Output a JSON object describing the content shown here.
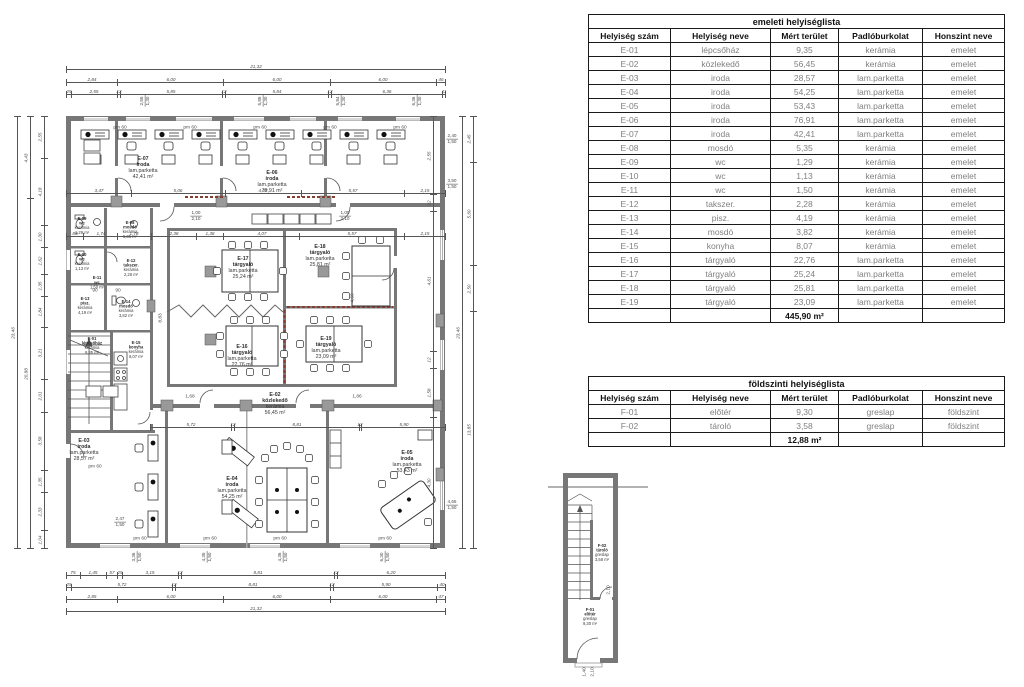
{
  "tables": {
    "emeleti": {
      "title": "emeleti helyiséglista",
      "headers": [
        "Helyiség szám",
        "Helyiség neve",
        "Mért terület",
        "Padlóburkolat",
        "Honszint neve"
      ],
      "col_widths": [
        82,
        100,
        68,
        84,
        82
      ],
      "rows": [
        [
          "E-01",
          "lépcsőház",
          "9,35",
          "kerámia",
          "emelet"
        ],
        [
          "E-02",
          "közlekedő",
          "56,45",
          "kerámia",
          "emelet"
        ],
        [
          "E-03",
          "iroda",
          "28,57",
          "lam.parketta",
          "emelet"
        ],
        [
          "E-04",
          "iroda",
          "54,25",
          "lam.parketta",
          "emelet"
        ],
        [
          "E-05",
          "iroda",
          "53,43",
          "lam.parketta",
          "emelet"
        ],
        [
          "E-06",
          "iroda",
          "76,91",
          "lam.parketta",
          "emelet"
        ],
        [
          "E-07",
          "iroda",
          "42,41",
          "lam.parketta",
          "emelet"
        ],
        [
          "E-08",
          "mosdó",
          "5,35",
          "kerámia",
          "emelet"
        ],
        [
          "E-09",
          "wc",
          "1,29",
          "kerámia",
          "emelet"
        ],
        [
          "E-10",
          "wc",
          "1,13",
          "kerámia",
          "emelet"
        ],
        [
          "E-11",
          "wc",
          "1,50",
          "kerámia",
          "emelet"
        ],
        [
          "E-12",
          "takszer.",
          "2,28",
          "kerámia",
          "emelet"
        ],
        [
          "E-13",
          "pisz.",
          "4,19",
          "kerámia",
          "emelet"
        ],
        [
          "E-14",
          "mosdó",
          "3,82",
          "kerámia",
          "emelet"
        ],
        [
          "E-15",
          "konyha",
          "8,07",
          "kerámia",
          "emelet"
        ],
        [
          "E-16",
          "tárgyaló",
          "22,76",
          "lam.parketta",
          "emelet"
        ],
        [
          "E-17",
          "tárgyaló",
          "25,24",
          "lam.parketta",
          "emelet"
        ],
        [
          "E-18",
          "tárgyaló",
          "25,81",
          "lam.parketta",
          "emelet"
        ],
        [
          "E-19",
          "tárgyaló",
          "23,09",
          "lam.parketta",
          "emelet"
        ]
      ],
      "total": "445,90 m²"
    },
    "foldszinti": {
      "title": "földszinti helyiséglista",
      "headers": [
        "Helyiség szám",
        "Helyiség neve",
        "Mért terület",
        "Padlóburkolat",
        "Honszint neve"
      ],
      "col_widths": [
        82,
        100,
        68,
        84,
        82
      ],
      "rows": [
        [
          "F-01",
          "előtér",
          "9,30",
          "greslap",
          "földszint"
        ],
        [
          "F-02",
          "tároló",
          "3,58",
          "greslap",
          "földszint"
        ]
      ],
      "total": "12,88 m²"
    }
  },
  "floor_plan": {
    "room_labels": [
      {
        "x": 143,
        "y": 168,
        "small": false,
        "lines": [
          "E-07",
          "iroda",
          "lam.parketta",
          "42,41 m²"
        ]
      },
      {
        "x": 272,
        "y": 182,
        "small": false,
        "lines": [
          "E-06",
          "iroda",
          "lam.parketta",
          "76,91 m²"
        ]
      },
      {
        "x": 82,
        "y": 226,
        "small": true,
        "lines": [
          "E-09",
          "wc",
          "kerámia",
          "1,29 m²"
        ]
      },
      {
        "x": 130,
        "y": 230,
        "small": true,
        "lines": [
          "E-08",
          "mosdó",
          "kerámia",
          "5,35 m²"
        ]
      },
      {
        "x": 82,
        "y": 262,
        "small": true,
        "lines": [
          "E-10",
          "wc",
          "kerámia",
          "1,13 m²"
        ]
      },
      {
        "x": 131,
        "y": 268,
        "small": true,
        "lines": [
          "E-12",
          "takszer.",
          "kerámia",
          "2,28 m²"
        ]
      },
      {
        "x": 97,
        "y": 283,
        "small": true,
        "lines": [
          "E-11",
          "wc",
          "1,50 m²"
        ]
      },
      {
        "x": 85,
        "y": 306,
        "small": true,
        "lines": [
          "E-13",
          "pisz.",
          "kerámia",
          "4,19 m²"
        ]
      },
      {
        "x": 126,
        "y": 309,
        "small": true,
        "lines": [
          "E-14",
          "mosdó",
          "kerámia",
          "3,82 m²"
        ]
      },
      {
        "x": 92,
        "y": 346,
        "small": true,
        "lines": [
          "E-01",
          "lépcsőház",
          "kerámia",
          "9,35 m²"
        ]
      },
      {
        "x": 136,
        "y": 350,
        "small": true,
        "lines": [
          "E-15",
          "konyha",
          "kerámia",
          "8,07 m²"
        ]
      },
      {
        "x": 243,
        "y": 268,
        "small": false,
        "lines": [
          "E-17",
          "tárgyaló",
          "lam.parketta",
          "25,24 m²"
        ]
      },
      {
        "x": 320,
        "y": 256,
        "small": false,
        "lines": [
          "E-18",
          "tárgyaló",
          "lam.parketta",
          "25,81 m²"
        ]
      },
      {
        "x": 242,
        "y": 356,
        "small": false,
        "lines": [
          "E-16",
          "tárgyaló",
          "lam.parketta",
          "22,76 m²"
        ]
      },
      {
        "x": 326,
        "y": 348,
        "small": false,
        "lines": [
          "E-19",
          "tárgyaló",
          "lam.parketta",
          "23,09 m²"
        ]
      },
      {
        "x": 275,
        "y": 404,
        "small": false,
        "lines": [
          "E-02",
          "közlekedő",
          "kerámia",
          "56,45 m²"
        ]
      },
      {
        "x": 84,
        "y": 450,
        "small": false,
        "lines": [
          "E-03",
          "iroda",
          "lam.parketta",
          "28,57 m²"
        ]
      },
      {
        "x": 232,
        "y": 488,
        "small": false,
        "lines": [
          "E-04",
          "iroda",
          "lam.parketta",
          "54,25 m²"
        ]
      },
      {
        "x": 407,
        "y": 462,
        "small": false,
        "lines": [
          "E-05",
          "iroda",
          "lam.parketta",
          "53,43 m²"
        ]
      }
    ],
    "annotations": [
      {
        "x": 120,
        "y": 127,
        "t": "pm 60"
      },
      {
        "x": 190,
        "y": 127,
        "t": "pm 60"
      },
      {
        "x": 260,
        "y": 127,
        "t": "pm 60"
      },
      {
        "x": 330,
        "y": 127,
        "t": "pm 60"
      },
      {
        "x": 400,
        "y": 127,
        "t": "pm 60"
      },
      {
        "x": 140,
        "y": 538,
        "t": "pm 60"
      },
      {
        "x": 210,
        "y": 538,
        "t": "pm 60"
      },
      {
        "x": 280,
        "y": 538,
        "t": "pm 60"
      },
      {
        "x": 385,
        "y": 538,
        "t": "pm 60"
      },
      {
        "x": 95,
        "y": 466,
        "t": "pm 60"
      },
      {
        "x": 95,
        "y": 290,
        "t": "90"
      },
      {
        "x": 118,
        "y": 290,
        "t": "90"
      },
      {
        "x": 160,
        "y": 318,
        "t": "8,83",
        "rot": true
      },
      {
        "x": 352,
        "y": 298,
        "t": "4,60",
        "rot": true
      },
      {
        "x": 190,
        "y": 396,
        "t": "1,68"
      },
      {
        "x": 357,
        "y": 396,
        "t": "1,86"
      }
    ],
    "fractions": [
      {
        "x": 452,
        "y": 139,
        "top": "2,40",
        "bottom": "1,50"
      },
      {
        "x": 452,
        "y": 184,
        "top": "3,50",
        "bottom": "1,50"
      },
      {
        "x": 452,
        "y": 505,
        "top": "4,65",
        "bottom": "1,50"
      },
      {
        "x": 120,
        "y": 522,
        "top": "2,47",
        "bottom": "1,50"
      },
      {
        "x": 196,
        "y": 216,
        "top": "1,00",
        "bottom": "2,10"
      },
      {
        "x": 345,
        "y": 216,
        "top": "1,00",
        "bottom": "2,10"
      },
      {
        "x": 145,
        "y": 101,
        "top": "2,55",
        "bottom": "1,30",
        "rot": true
      },
      {
        "x": 263,
        "y": 101,
        "top": "5,85",
        "bottom": "1,30",
        "rot": true
      },
      {
        "x": 341,
        "y": 101,
        "top": "5,84",
        "bottom": "1,30",
        "rot": true
      },
      {
        "x": 417,
        "y": 101,
        "top": "6,36",
        "bottom": "1,30",
        "rot": true
      },
      {
        "x": 137,
        "y": 557,
        "top": "3,36",
        "bottom": "1,50",
        "rot": true
      },
      {
        "x": 207,
        "y": 557,
        "top": "4,35",
        "bottom": "1,50",
        "rot": true
      },
      {
        "x": 283,
        "y": 557,
        "top": "4,36",
        "bottom": "1,50",
        "rot": true
      },
      {
        "x": 385,
        "y": 557,
        "top": "6,30",
        "bottom": "1,50",
        "rot": true
      }
    ],
    "dim_chains": [
      {
        "x": 66,
        "y": 66,
        "len": 379,
        "vert": false,
        "labels": [
          "21,32"
        ],
        "weights": [
          1
        ]
      },
      {
        "x": 66,
        "y": 79,
        "len": 379,
        "vert": false,
        "labels": [
          "2,84",
          "6,00",
          "6,00",
          "6,00",
          "46"
        ],
        "weights": [
          2.84,
          6,
          6,
          6,
          0.46
        ]
      },
      {
        "x": 66,
        "y": 91,
        "len": 379,
        "vert": false,
        "labels": [
          "25",
          "2,55",
          "12",
          "5,85",
          "12",
          "5,84",
          "12",
          "6,36",
          "11"
        ],
        "weights": [
          0.25,
          2.55,
          0.12,
          5.85,
          0.12,
          5.84,
          0.12,
          6.36,
          0.11
        ]
      },
      {
        "x": 66,
        "y": 190,
        "len": 379,
        "vert": false,
        "labels": [
          "3,47",
          "5,06",
          "4,07",
          "5,57",
          "2,15"
        ],
        "weights": [
          3.47,
          5.06,
          4.07,
          5.57,
          2.15
        ]
      },
      {
        "x": 66,
        "y": 233,
        "len": 379,
        "vert": false,
        "labels": [
          "88",
          "1,74",
          "1,78",
          "2,38",
          "1,38",
          "4,07",
          "5,57",
          "2,15"
        ],
        "weights": [
          0.88,
          1.74,
          1.78,
          2.38,
          1.38,
          4.07,
          5.57,
          2.15
        ]
      },
      {
        "x": 150,
        "y": 424,
        "len": 295,
        "vert": false,
        "labels": [
          "5,72",
          "12",
          "8,81",
          "12",
          "5,90"
        ],
        "weights": [
          5.72,
          0.12,
          8.81,
          0.12,
          5.9
        ]
      },
      {
        "x": 66,
        "y": 572,
        "len": 379,
        "vert": false,
        "labels": [
          "75",
          "1,45",
          "57",
          "25",
          "3,15",
          "12",
          "8,81",
          "12",
          "6,20"
        ],
        "weights": [
          0.75,
          1.45,
          0.57,
          0.25,
          3.15,
          0.12,
          8.81,
          0.12,
          6.2
        ]
      },
      {
        "x": 66,
        "y": 584,
        "len": 379,
        "vert": false,
        "labels": [
          "25",
          "5,72",
          "12",
          "8,81",
          "12",
          "5,90",
          "40"
        ],
        "weights": [
          0.25,
          5.72,
          0.12,
          8.81,
          0.12,
          5.9,
          0.4
        ]
      },
      {
        "x": 66,
        "y": 596,
        "len": 379,
        "vert": false,
        "labels": [
          "2,85",
          "6,00",
          "6,00",
          "6,00",
          "47"
        ],
        "weights": [
          2.85,
          6,
          6,
          6,
          0.47
        ]
      },
      {
        "x": 66,
        "y": 608,
        "len": 379,
        "vert": false,
        "labels": [
          "21,32"
        ],
        "weights": [
          1
        ]
      },
      {
        "x": 14,
        "y": 116,
        "len": 432,
        "vert": true,
        "labels": [
          "23,46"
        ],
        "weights": [
          1
        ]
      },
      {
        "x": 27,
        "y": 116,
        "len": 432,
        "vert": true,
        "labels": [
          "4,43",
          "20,88"
        ],
        "weights": [
          4.43,
          19.03
        ]
      },
      {
        "x": 41,
        "y": 116,
        "len": 432,
        "vert": true,
        "labels": [
          "2,55",
          "4,18",
          "1,30",
          "1,62",
          "1,35",
          "1,84",
          "3,21",
          "2,01",
          "3,58",
          "1,35",
          "2,33",
          "1,04"
        ],
        "weights": [
          2.55,
          4.18,
          1.3,
          1.62,
          1.35,
          1.84,
          3.21,
          2.01,
          3.58,
          1.35,
          2.33,
          1.04
        ]
      },
      {
        "x": 459,
        "y": 116,
        "len": 432,
        "vert": true,
        "labels": [
          "23,46"
        ],
        "weights": [
          1
        ]
      },
      {
        "x": 470,
        "y": 116,
        "len": 432,
        "vert": true,
        "labels": [
          "2,45",
          "5,60",
          "2,50",
          "13,85"
        ],
        "weights": [
          2.45,
          5.6,
          2.5,
          12.91
        ]
      },
      {
        "x": 430,
        "y": 116,
        "len": 432,
        "vert": true,
        "labels": [
          "2,55",
          "12",
          "4,61",
          "12",
          "1,58",
          "4,30"
        ],
        "weights": [
          2.55,
          0.5,
          4.61,
          0.5,
          1.58,
          4.3
        ]
      }
    ]
  },
  "mini_plan": {
    "room_labels": [
      {
        "x": 602,
        "y": 553,
        "small": true,
        "lines": [
          "F-02",
          "tároló",
          "greslap",
          "3,58 m²"
        ]
      },
      {
        "x": 590,
        "y": 617,
        "small": true,
        "lines": [
          "F-01",
          "előtér",
          "greslap",
          "9,30 m²"
        ]
      }
    ],
    "annotations": [
      {
        "x": 608,
        "y": 590,
        "t": "2,10",
        "rot": true
      },
      {
        "x": 584,
        "y": 672,
        "t": "1,40",
        "rot": true
      },
      {
        "x": 592,
        "y": 672,
        "t": "2,10",
        "rot": true
      }
    ]
  }
}
